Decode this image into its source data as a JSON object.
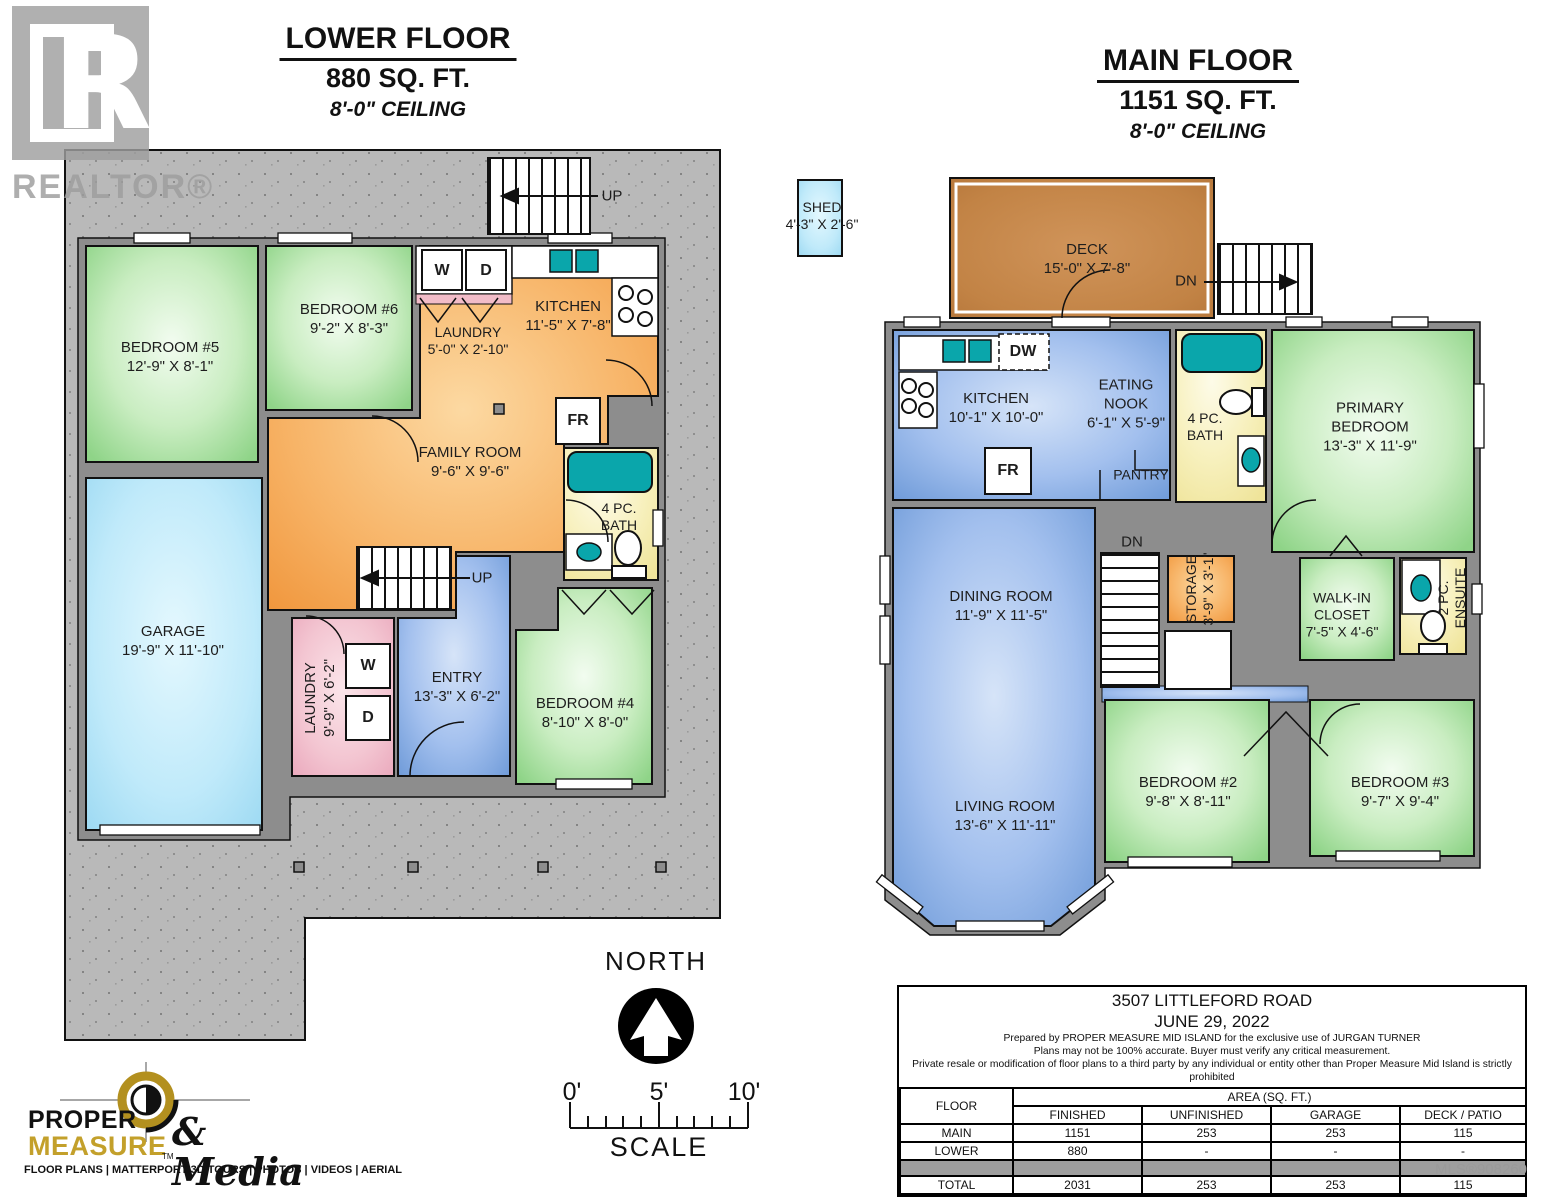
{
  "lower_floor": {
    "title": "LOWER FLOOR",
    "area": "880 SQ. FT.",
    "ceiling": "8'-0\" CEILING",
    "rooms": {
      "bedroom5": {
        "name": "BEDROOM #5",
        "dims": "12'-9\" X 8'-1\""
      },
      "bedroom6": {
        "name": "BEDROOM #6",
        "dims": "9'-2\" X 8'-3\""
      },
      "laundry_upper": {
        "name": "LAUNDRY",
        "dims": "5'-0\" X 2'-10\""
      },
      "kitchen": {
        "name": "KITCHEN",
        "dims": "11'-5\" X 7'-8\""
      },
      "family_room": {
        "name": "FAMILY ROOM",
        "dims": "9'-6\" X 9'-6\""
      },
      "bath": {
        "line1": "4 PC.",
        "line2": "BATH"
      },
      "garage": {
        "name": "GARAGE",
        "dims": "19'-9\" X 11'-10\""
      },
      "laundry_lower": {
        "name": "LAUNDRY",
        "dims": "9'-9\" X 6'-2\""
      },
      "entry": {
        "name": "ENTRY",
        "dims": "13'-3\" X 6'-2\""
      },
      "bedroom4": {
        "name": "BEDROOM #4",
        "dims": "8'-10\" X 8'-0\""
      }
    },
    "stairs": {
      "up_top": "UP",
      "up_mid": "UP"
    },
    "fixtures": {
      "washer": "W",
      "dryer": "D",
      "fridge": "FR"
    }
  },
  "main_floor": {
    "title": "MAIN FLOOR",
    "area": "1151 SQ. FT.",
    "ceiling": "8'-0\" CEILING",
    "rooms": {
      "shed": {
        "name": "SHED",
        "dims": "4'-3\" X 2'-6\""
      },
      "deck": {
        "name": "DECK",
        "dims": "15'-0\" X 7'-8\""
      },
      "kitchen": {
        "name": "KITCHEN",
        "dims": "10'-1\" X 10'-0\""
      },
      "eating_nook": {
        "line1": "EATING",
        "line2": "NOOK",
        "dims": "6'-1\" X 5'-9\""
      },
      "pantry": {
        "name": "PANTRY"
      },
      "bath": {
        "line1": "4 PC.",
        "line2": "BATH"
      },
      "primary": {
        "line1": "PRIMARY",
        "line2": "BEDROOM",
        "dims": "13'-3\" X 11'-9\""
      },
      "dining": {
        "name": "DINING ROOM",
        "dims": "11'-9\" X 11'-5\""
      },
      "storage": {
        "name": "STORAGE",
        "dims": "3'-9\" X 3'-1\""
      },
      "walkin": {
        "line1": "WALK-IN",
        "line2": "CLOSET",
        "dims": "7'-5\" X 4'-6\""
      },
      "ensuite": {
        "line1": "2 PC.",
        "line2": "ENSUITE"
      },
      "living": {
        "name": "LIVING ROOM",
        "dims": "13'-6\" X 11'-11\""
      },
      "bedroom2": {
        "name": "BEDROOM #2",
        "dims": "9'-8\" X 8'-11\""
      },
      "bedroom3": {
        "name": "BEDROOM #3",
        "dims": "9'-7\" X 9'-4\""
      }
    },
    "stairs": {
      "dn_deck": "DN",
      "dn_interior": "DN"
    },
    "fixtures": {
      "fridge": "FR",
      "dishwasher": "DW"
    }
  },
  "compass": {
    "label": "NORTH"
  },
  "scale_bar": {
    "tick0": "0'",
    "tick5": "5'",
    "tick10": "10'",
    "label": "SCALE"
  },
  "info_box": {
    "address": "3507 LITTLEFORD ROAD",
    "date": "JUNE 29, 2022",
    "prepared_line": "Prepared by PROPER MEASURE MID ISLAND for the exclusive use of JURGAN TURNER",
    "accuracy_line": "Plans may not be 100% accurate.  Buyer must verify any critical measurement.",
    "private_line": "Private resale  or modification of floor plans to a third party by any individual or entity other than Proper Measure Mid Island is strictly prohibited",
    "table": {
      "floor_header": "FLOOR",
      "area_header": "AREA (SQ. FT.)",
      "columns": [
        "FINISHED",
        "UNFINISHED",
        "GARAGE",
        "DECK / PATIO"
      ],
      "rows": [
        {
          "floor": "MAIN",
          "finished": "1151",
          "unfinished": "253",
          "garage": "253",
          "deck": "115"
        },
        {
          "floor": "LOWER",
          "finished": "880",
          "unfinished": "-",
          "garage": "-",
          "deck": "-"
        },
        {
          "floor": "TOTAL",
          "finished": "2031",
          "unfinished": "253",
          "garage": "253",
          "deck": "115"
        }
      ]
    },
    "mls": "MLS®908260"
  },
  "branding": {
    "realtor": "REALTOR®",
    "realtor_r": "R",
    "proper": "PROPER",
    "measure": "MEASURE",
    "tm": "TM",
    "media": "& Media",
    "services": "FLOOR PLANS | MATTERPORT 3D TOURS | PHOTOS | VIDEOS | AERIAL"
  },
  "colors": {
    "concrete": "#b9b9b9",
    "wall": "#8d8d8d",
    "outline": "#111111",
    "bedroom_green": "#8fd488",
    "living_blue": "#6e9ad8",
    "kitchen_orange": "#f0963c",
    "garage_cyan": "#9cd9f2",
    "laundry_pink": "#eaa8bc",
    "bath_yellow": "#efe49a",
    "fixture_teal": "#0aa6ab",
    "deck_brown": "#c28345",
    "logo_gold": "#c3a02b"
  }
}
